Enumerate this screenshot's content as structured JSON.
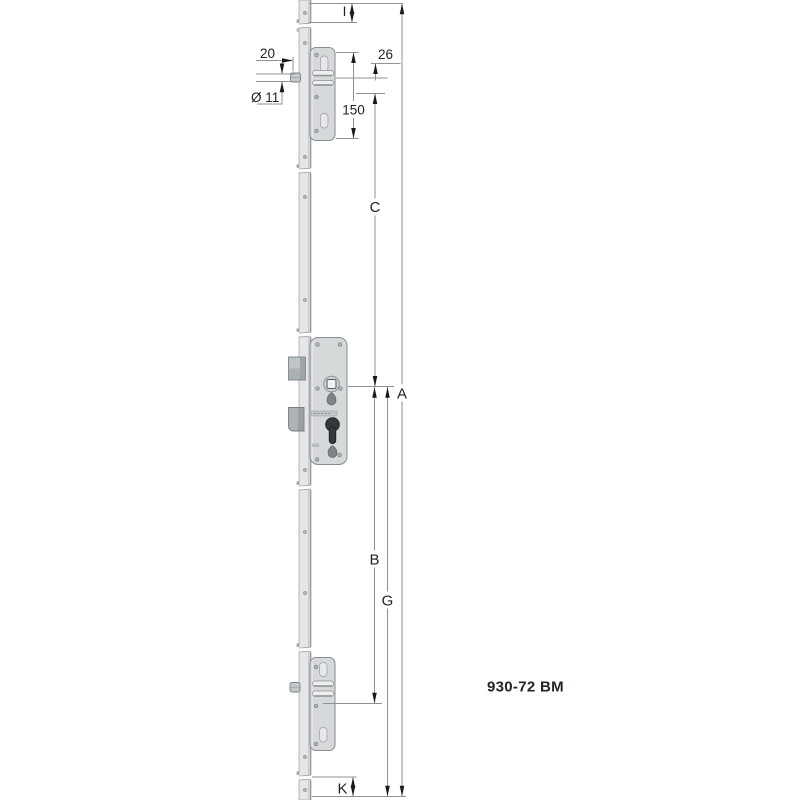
{
  "drawing": {
    "product_code": "930-72 BM",
    "labels": {
      "i": "I",
      "pin_offset": "20",
      "pin_diameter": "Ø 11",
      "dim26": "26",
      "dim150": "150",
      "c": "C",
      "a": "A",
      "b": "B",
      "g": "G",
      "k": "K"
    },
    "colors": {
      "background": "#ffffff",
      "rail_fill": "#e4e6e7",
      "case_fill": "#d6d9da",
      "case_outline": "#878d90",
      "dimension_line": "#8d9396",
      "arrow": "#17191b",
      "label_text": "#1d2124"
    }
  }
}
